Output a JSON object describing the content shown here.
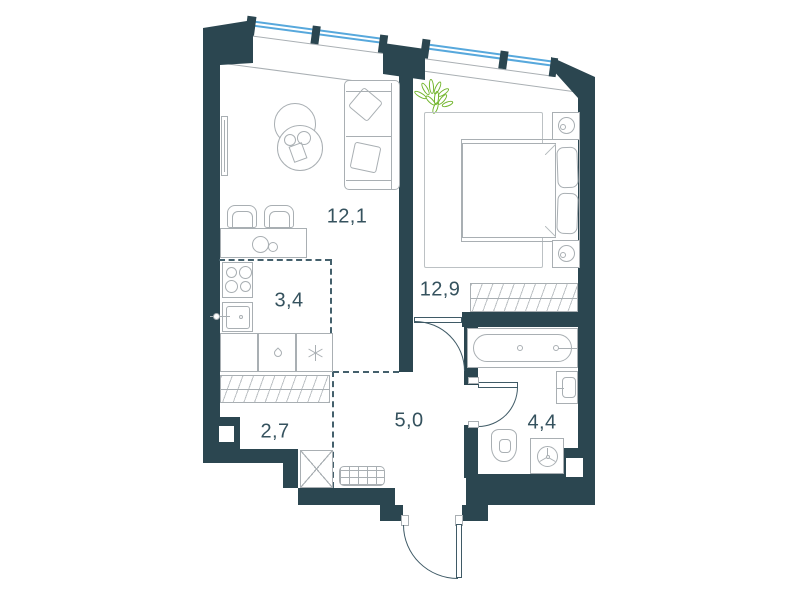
{
  "plan": {
    "type": "apartment-floor-plan",
    "rooms": {
      "living": {
        "area": "12,1",
        "furniture": [
          "sofa-icon",
          "cushion-icon",
          "coffee-table-icon",
          "tv-icon",
          "dining-table-icon",
          "chair-icon",
          "plate-icon"
        ]
      },
      "kitchen": {
        "area": "3,4",
        "furniture": [
          "stove-icon",
          "kitchen-sink-icon",
          "cabinet-icon",
          "dishwasher-drop-icon",
          "fridge-snowflake-icon"
        ]
      },
      "bedroom": {
        "area": "12,9",
        "furniture": [
          "double-bed-icon",
          "pillow-icon",
          "nightstand-icon",
          "lamp-icon",
          "rug-icon",
          "plant-icon",
          "wardrobe-hatch-icon"
        ]
      },
      "wardrobe": {
        "area": "2,7",
        "furniture": [
          "wardrobe-hatch-icon",
          "shaft-x-icon",
          "wall-niche-icon"
        ]
      },
      "hallway": {
        "area": "5,0",
        "furniture": [
          "doormat-icon",
          "entrance-door-icon"
        ]
      },
      "bathroom": {
        "area": "4,4",
        "furniture": [
          "bathtub-icon",
          "washbasin-icon",
          "toilet-icon",
          "washing-machine-icon"
        ]
      }
    },
    "openings": [
      "window-band-living",
      "window-band-bedroom",
      "bedroom-door",
      "bathroom-door",
      "entrance-door"
    ]
  },
  "colors": {
    "wall": "#2B4650",
    "window_glass": "#57A8DC",
    "furniture_line": "#A9AFB3",
    "plant": "#72B52C",
    "label_text": "#35525E",
    "zone_dash": "#44606C"
  }
}
